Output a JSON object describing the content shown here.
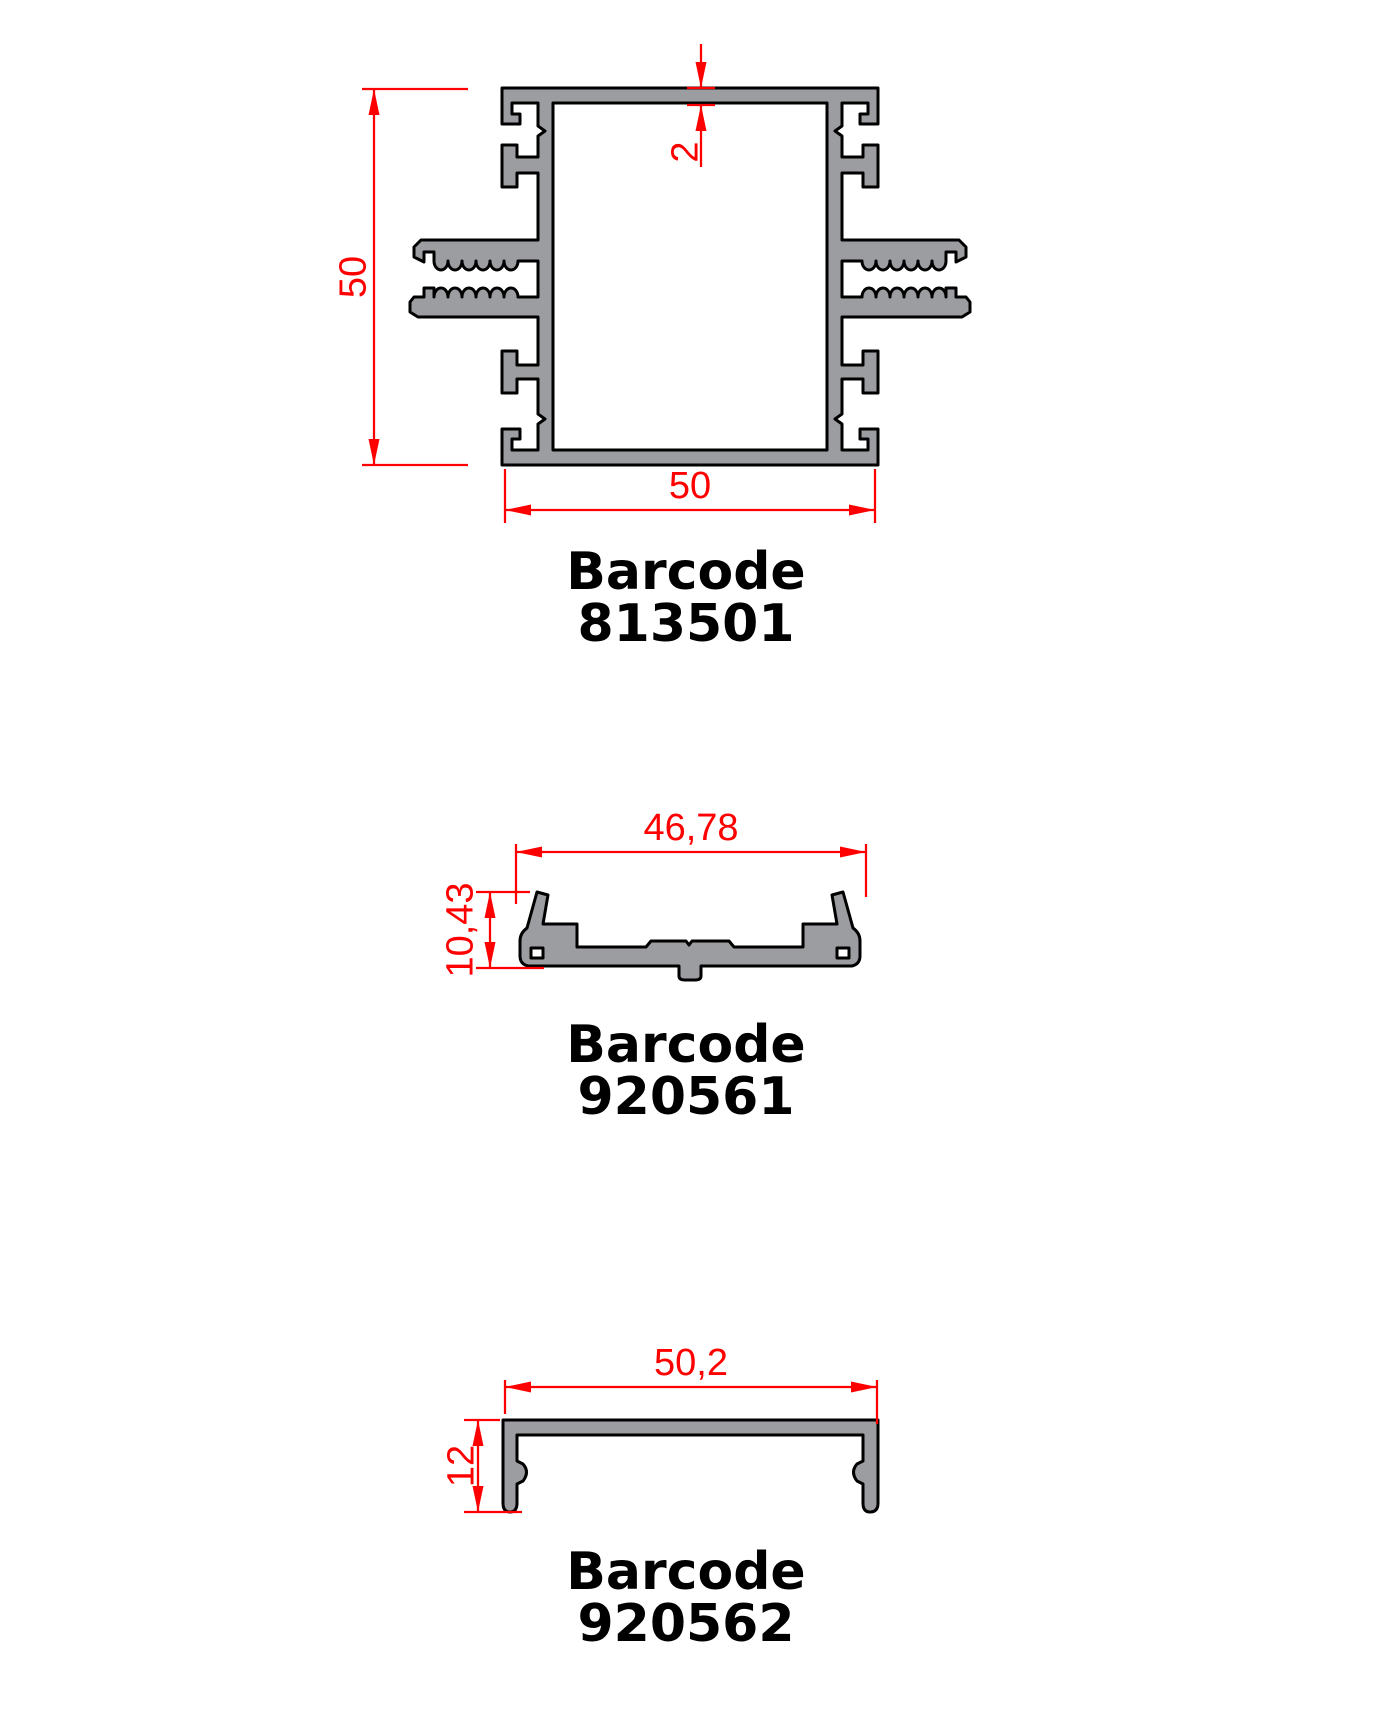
{
  "drawing": {
    "colors": {
      "dimension_red": "#ff0000",
      "profile_fill": "#9b9da0",
      "outline_black": "#000000",
      "label_black": "#000000",
      "background": "#ffffff"
    },
    "profiles": [
      {
        "name": "square-mullion-profile",
        "barcode_label": "Barcode",
        "barcode_number": "813501",
        "dims": {
          "height": "50",
          "width": "50",
          "wall": "2"
        }
      },
      {
        "name": "glazing-bead-clip-profile",
        "barcode_label": "Barcode",
        "barcode_number": "920561",
        "dims": {
          "width": "46,78",
          "height": "10,43"
        }
      },
      {
        "name": "cover-cap-profile",
        "barcode_label": "Barcode",
        "barcode_number": "920562",
        "dims": {
          "width": "50,2",
          "height": "12"
        }
      }
    ]
  }
}
